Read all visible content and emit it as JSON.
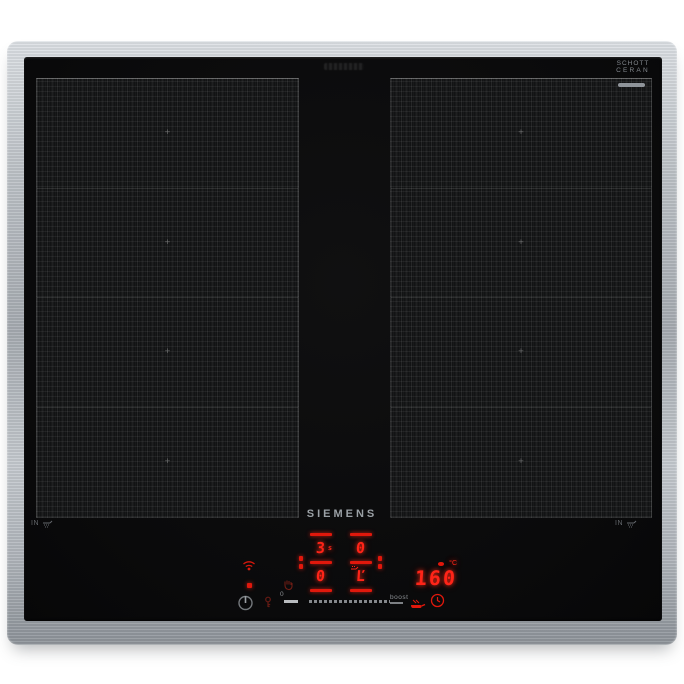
{
  "brand_logo": "SIEMENS",
  "glass_brand": {
    "line1": "SCHOTT",
    "line2": "CERAN"
  },
  "edge_markings": {
    "left": "IN",
    "right": "IN"
  },
  "controls": {
    "left_zone": {
      "upper_value": "3",
      "upper_suffix": "s",
      "lower_value": "0"
    },
    "right_zone": {
      "upper_value": "0",
      "lower_value": "Ľ"
    },
    "temperature": {
      "value": "160",
      "unit": "°C"
    },
    "slider": {
      "start_label": "0",
      "end_label": "boost"
    }
  },
  "icons": {
    "wifi": "home-connect-wifi",
    "status_dot": "standby-indicator",
    "power": "standby-power",
    "key": "child-lock-key",
    "hand": "wipe-protection-hand",
    "pan": "fry-sensor-pan",
    "clock": "timer-clock",
    "steak": "fry-level-steak",
    "induction_pan": "induction-pan-symbol"
  },
  "colors": {
    "led_red": "#ff2418",
    "steel": "#b7bcc1",
    "glass": "#0b0b0c",
    "label_gray": "#8e9398"
  }
}
